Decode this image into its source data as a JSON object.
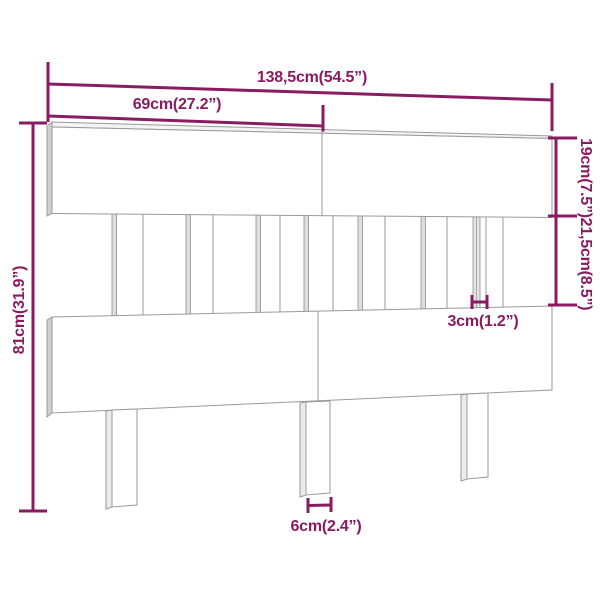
{
  "diagram": {
    "subject": "headboard-dimension-diagram",
    "colors": {
      "dimension_accent": "#8A1B61",
      "outline": "#9A9A9A",
      "background": "#FFFFFF"
    },
    "labels": {
      "total_width": "138,5cm(54.5”)",
      "upper_board_width": "69cm(27.2”)",
      "total_height": "81cm(31.9”)",
      "top_board_height": "19cm(7.5”)",
      "middle_section_height": "21,5cm(8.5”)",
      "slat_gap_width": "3cm(1.2”)",
      "leg_width": "6cm(2.4”)"
    }
  }
}
